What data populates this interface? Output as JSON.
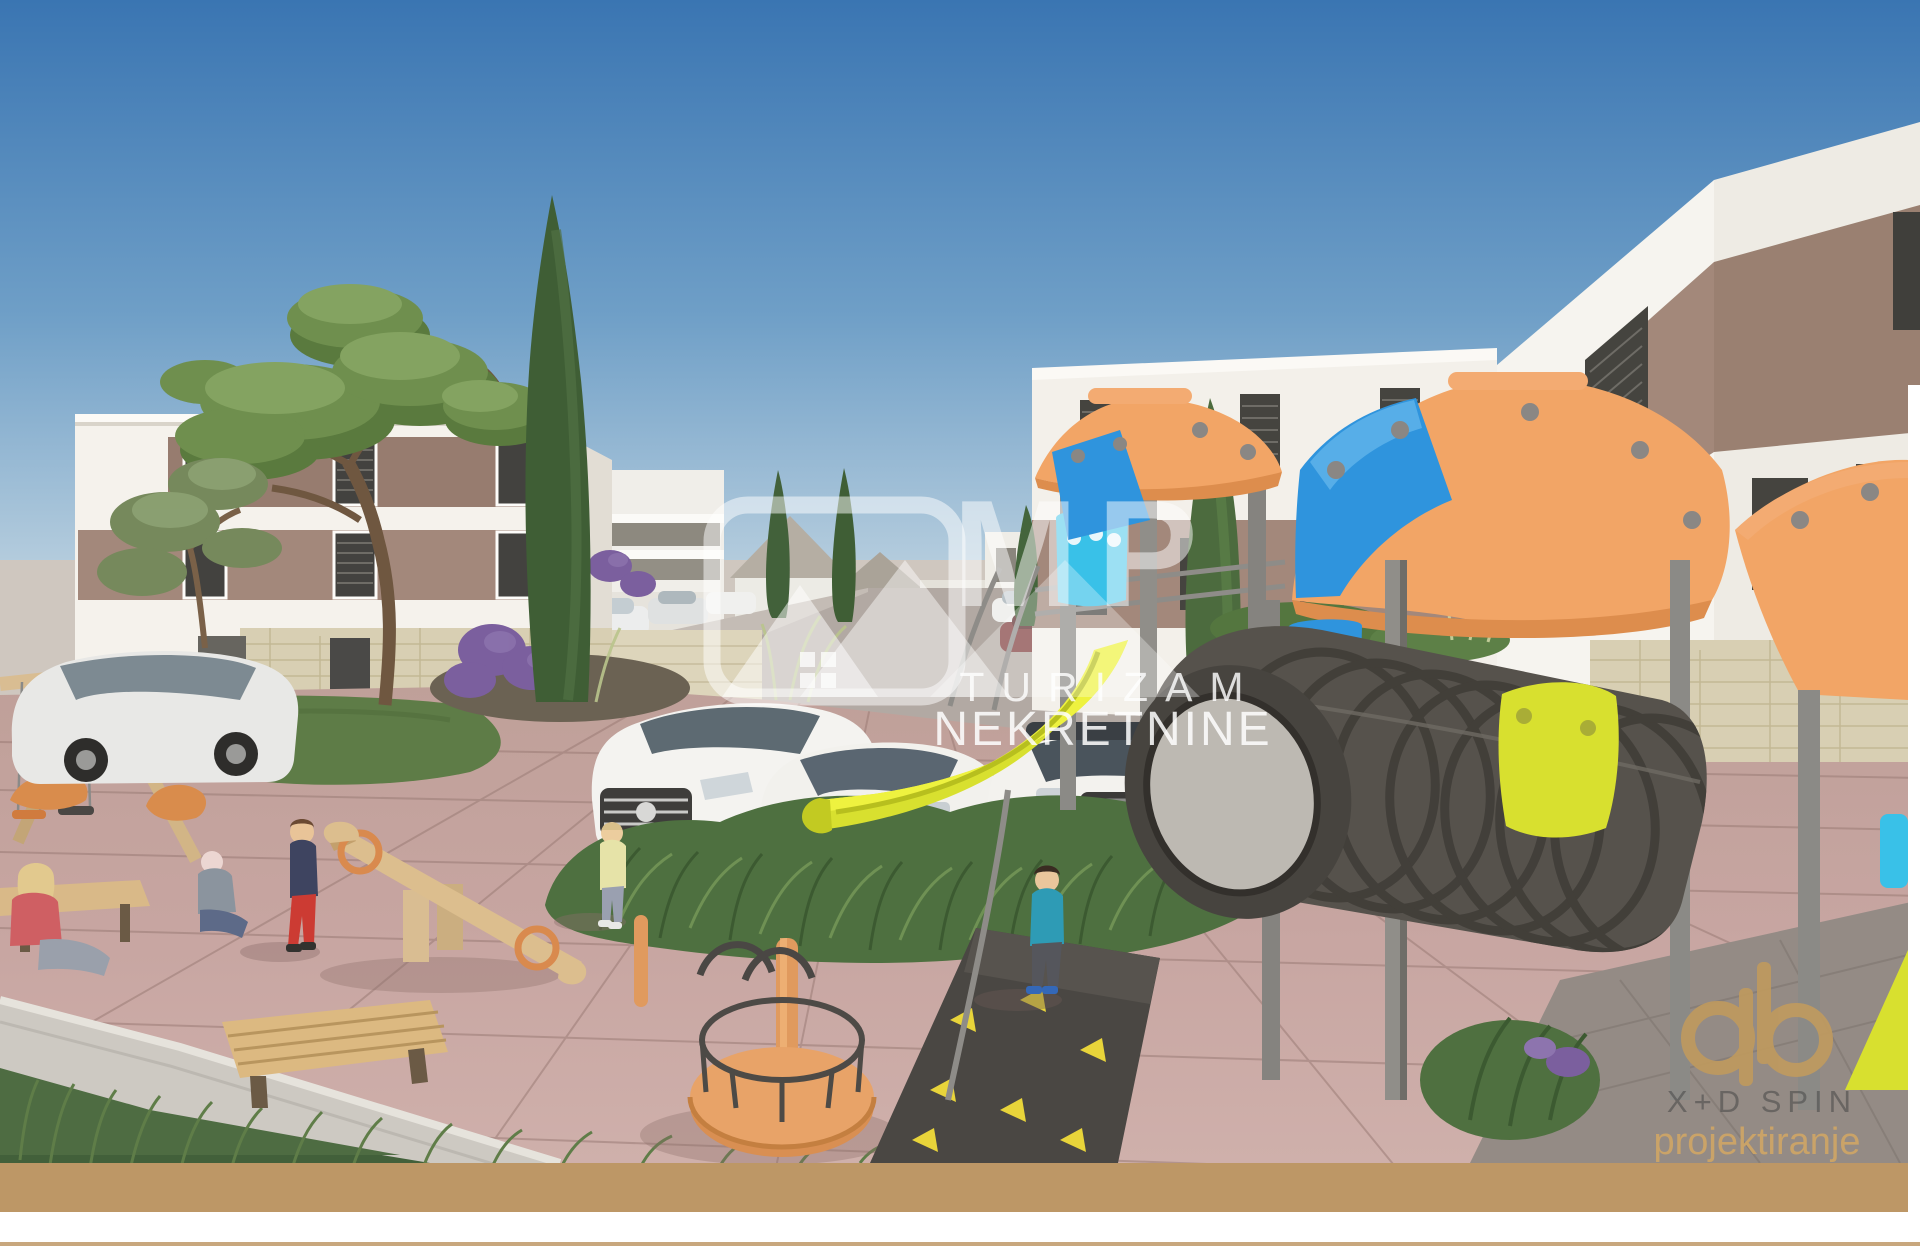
{
  "scene": {
    "alt": "3D architectural rendering of a residential complex courtyard with children's playground, parked cars, cypress and pine trees and modern white apartment buildings with brown facade bands",
    "watermark": {
      "monogram": "MP",
      "word1": "TURIZAM",
      "word2": "NEKRETNINE"
    },
    "credit": {
      "line1": "X+D SPIN",
      "line2": "projektiranje"
    },
    "colors": {
      "sky_top": "#3a75b2",
      "sky_horizon": "#dde7ec",
      "facade_white": "#f5f2ec",
      "facade_band": "#a3887b",
      "facade_band_dark": "#977c6f",
      "stone_base": "#d8cfb3",
      "pavement": "#c7a5a1",
      "asphalt": "#b2a9a3",
      "concrete": "#cdc9c2",
      "playground_orange": "#f2a566",
      "playground_blue": "#2f94dd",
      "playground_cyan": "#39c1e8",
      "slide_yellow": "#d8e02f",
      "tunnel_gray": "#56524c",
      "post_gray": "#908e89",
      "tree_green": "#6f8f4e",
      "cypress_green": "#3f5e35",
      "grass_green": "#5f7d48",
      "footer_gold": "#bd9766",
      "logo_gold": "#bf9a5f",
      "watermark_white": "#ffffff"
    }
  }
}
